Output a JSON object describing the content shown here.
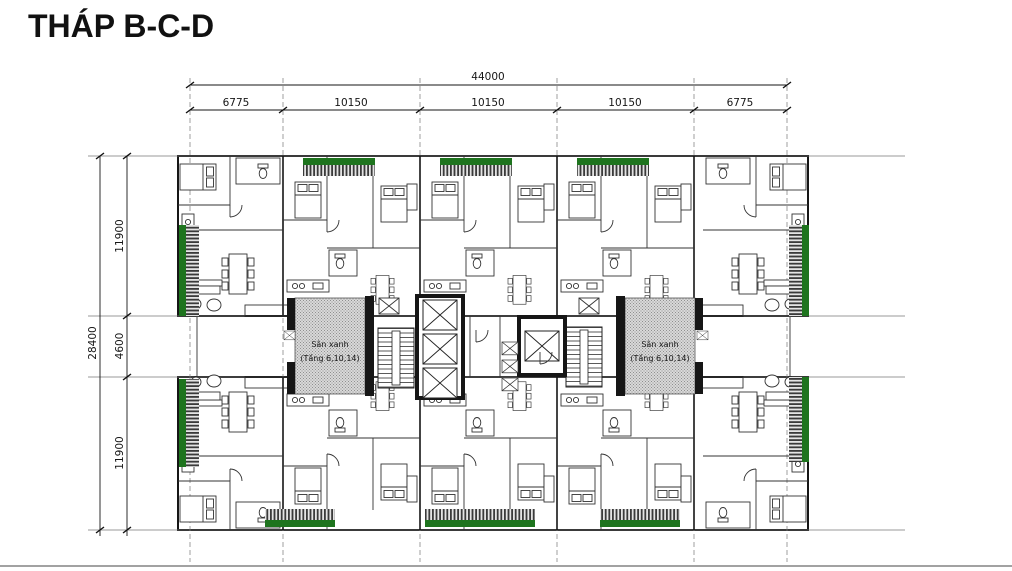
{
  "title": "THÁP B-C-D",
  "dimensions": {
    "total_width": "44000",
    "width_segments": [
      "6775",
      "10150",
      "10150",
      "10150",
      "6775"
    ],
    "total_depth": "28400",
    "depth_segments": [
      "11900",
      "4600",
      "11900"
    ]
  },
  "labels": {
    "green_yard_line1": "Sân xanh",
    "green_yard_line2": "(Tầng 6,10,14)"
  },
  "colors": {
    "balcony_green": "#1e741e",
    "yard_fill": "#d9d9d9",
    "yard_text": "#6b4a3c",
    "wall": "#161616"
  }
}
